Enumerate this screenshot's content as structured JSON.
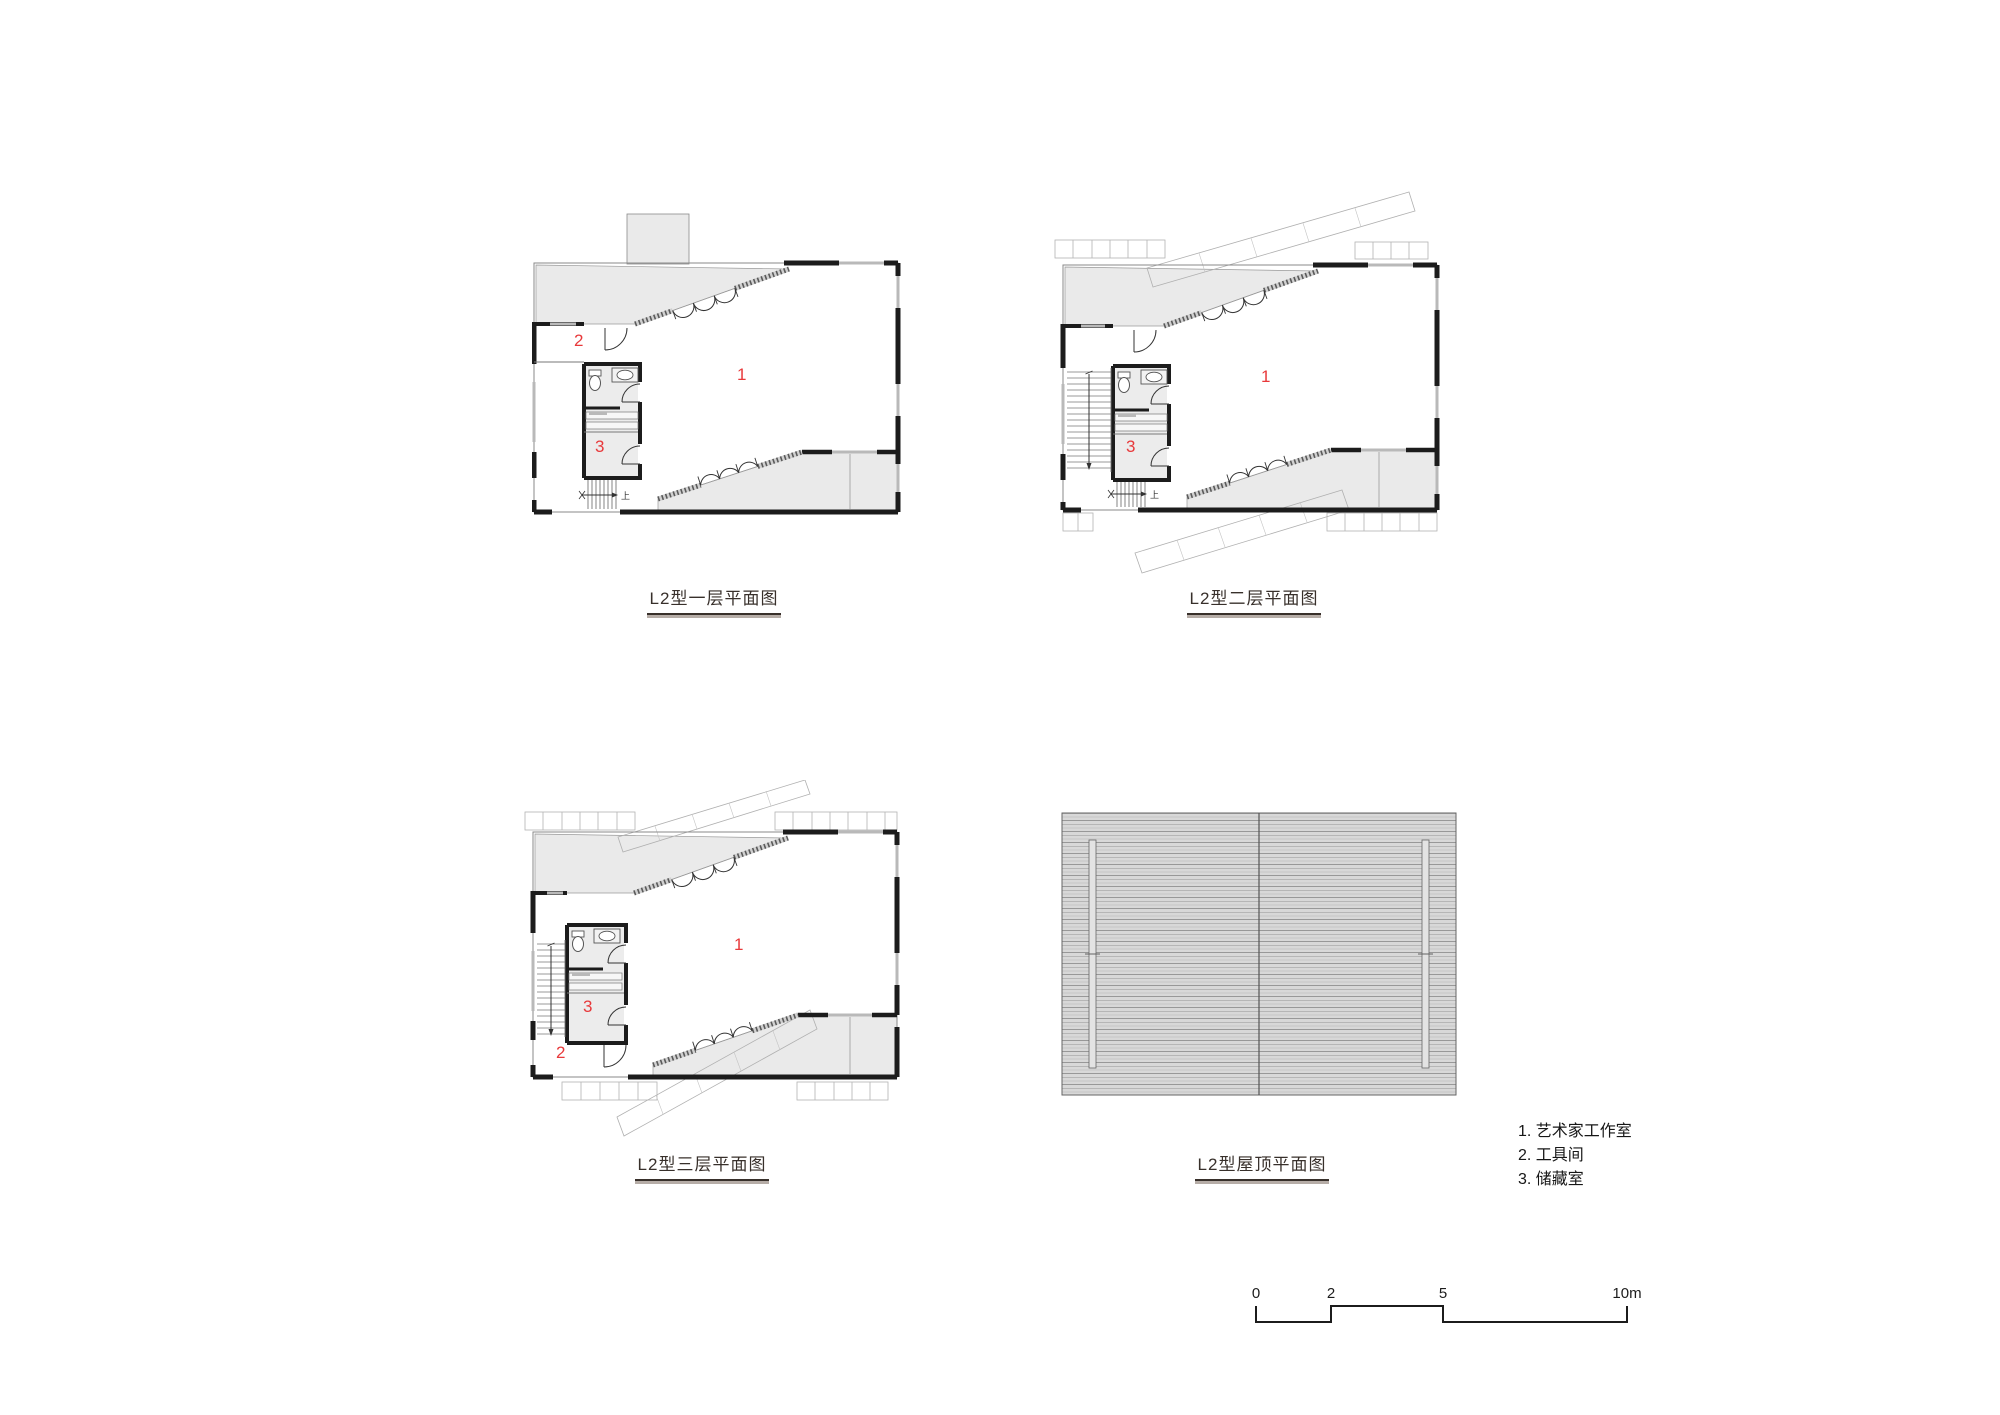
{
  "sheet": {
    "background": "#ffffff"
  },
  "rooms": {
    "one": "1",
    "two": "2",
    "three": "3"
  },
  "stairs": {
    "up_label": "上"
  },
  "plans": {
    "floor1": {
      "caption": "L2型一层平面图"
    },
    "floor2": {
      "caption": "L2型二层平面图"
    },
    "floor3": {
      "caption": "L2型三层平面图"
    },
    "roof": {
      "caption": "L2型屋顶平面图"
    }
  },
  "legend": {
    "items": [
      "1. 艺术家工作室",
      "2. 工具间",
      "3. 储藏室"
    ]
  },
  "scale_bar": {
    "labels": [
      "0",
      "2",
      "5",
      "10m"
    ]
  },
  "colors": {
    "room_number": "#e8393b",
    "wall": "#1c1c1c",
    "fill_light": "#eaeaea",
    "hatch_base": "#d8d8d8"
  }
}
